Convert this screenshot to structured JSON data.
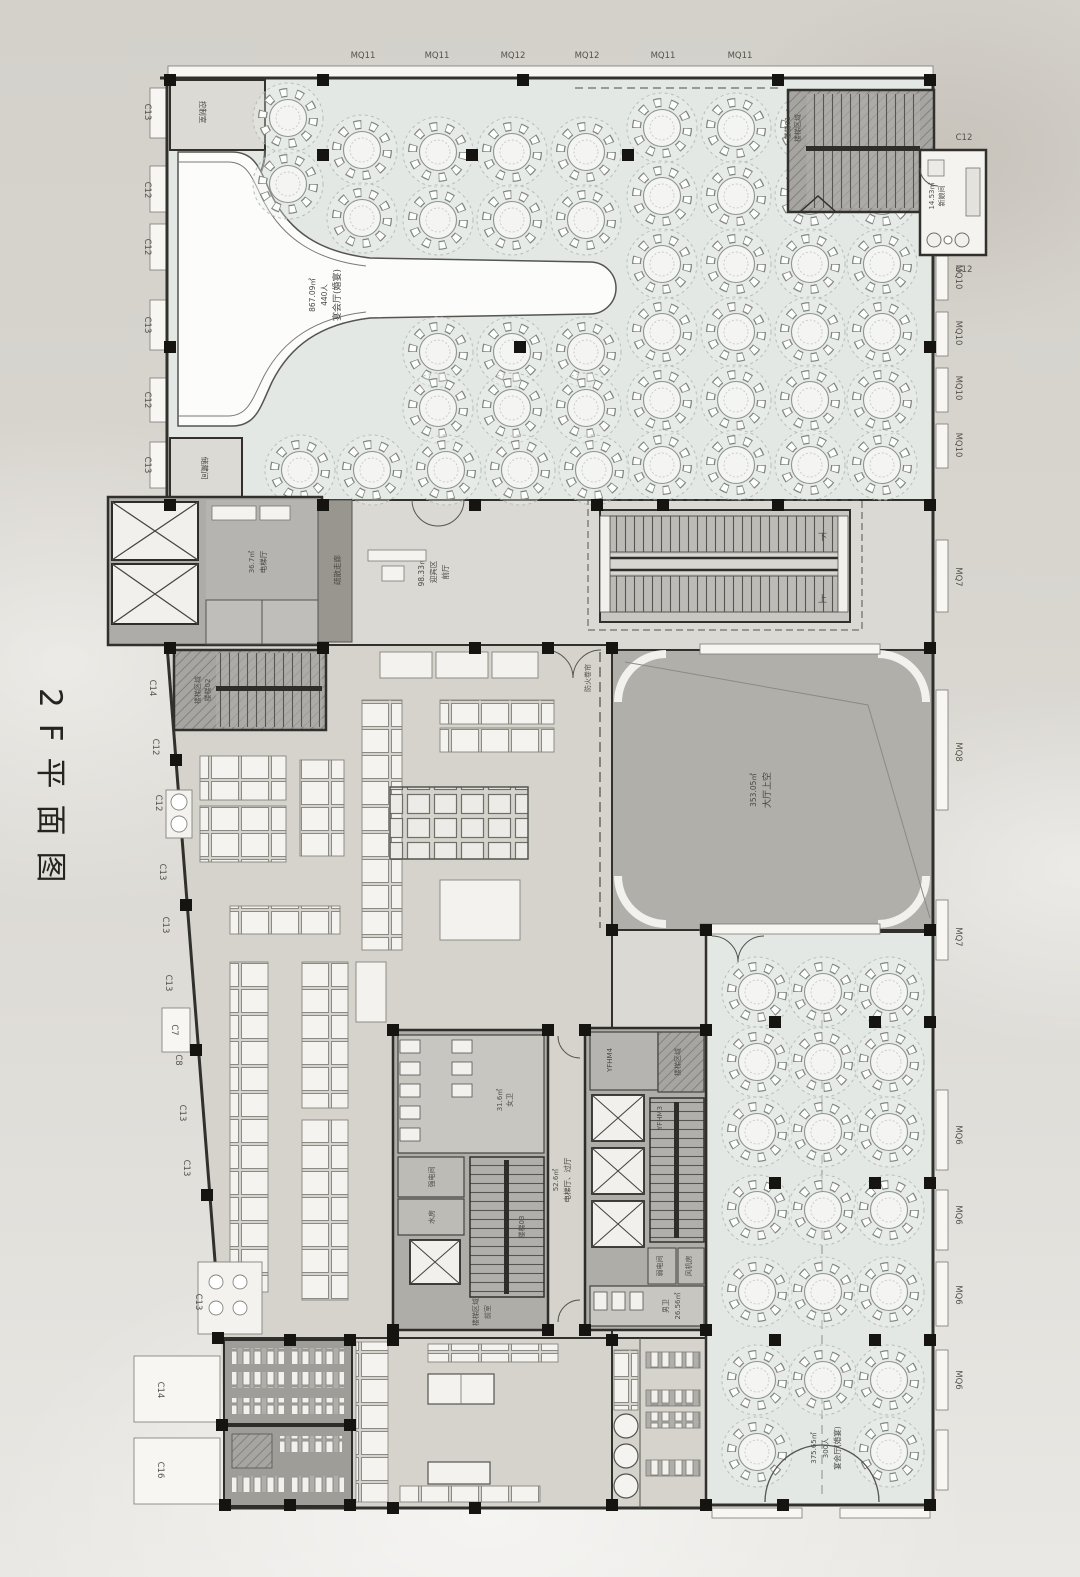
{
  "page": {
    "side_title": "2F平面图"
  },
  "facade": {
    "top": [
      "MQ11",
      "MQ11",
      "MQ12",
      "MQ12",
      "MQ11",
      "MQ11"
    ],
    "left_upper": [
      "C13",
      "C12",
      "C12",
      "C13",
      "C12",
      "C13"
    ],
    "left_mid": [
      "C14",
      "C12",
      "C12",
      "C13",
      "C13",
      "C13",
      "C7",
      "C8",
      "C13",
      "C13",
      "C13"
    ],
    "left_lower": [
      "C14",
      "C16"
    ],
    "right": [
      "C12",
      "C12",
      "MQ10",
      "MQ10",
      "MQ10",
      "MQ10",
      "MQ7",
      "MQ8",
      "MQ7",
      "MQ6",
      "MQ6",
      "MQ6",
      "MQ6"
    ]
  },
  "rooms": {
    "control_room": "控制室",
    "storage": "储藏间",
    "banquet_main": {
      "name": "宴会厅(婚宴)",
      "capacity": "440人",
      "area": "867.09㎡"
    },
    "stair01": {
      "zone": "楼梯区域",
      "name": "楼梯01"
    },
    "bride_room": {
      "name": "新娘间",
      "area": "14.53㎡"
    },
    "foyer": {
      "line1": "前厅",
      "line2": "迎宾区",
      "area": "98.33㎡"
    },
    "corridor": "疏散走廊",
    "elevator_hall": {
      "name": "电梯厅",
      "area": "36.7㎡"
    },
    "stair02": {
      "zone": "楼梯区域",
      "name": "楼梯02"
    },
    "void": {
      "name": "大厅上空",
      "area": "353.05㎡"
    },
    "fire_shutter": "防火卷帘",
    "womens": {
      "name": "女卫",
      "area": "31.6㎡"
    },
    "strong_electric": "强电间",
    "water_room": "水房",
    "stair03": "楼梯03",
    "vestibule": "前室",
    "stair_zone_left": "楼梯区域",
    "elevator_lobby": {
      "name": "电梯厅、过厅",
      "area": "52.6㎡"
    },
    "yfhm4": "YFHM4",
    "yfhm3": "YFHM3",
    "stair_zone_right": "楼梯区域",
    "weak_electric": "弱电间",
    "fan_room": "风机房",
    "mens": {
      "name": "男卫",
      "area": "26.56㎡"
    },
    "banquet_south": {
      "name": "宴会厅(婚宴)",
      "capacity": "300人",
      "area": "375.65㎡"
    }
  },
  "escalator": {
    "down_label": "下",
    "up_label": "上"
  }
}
